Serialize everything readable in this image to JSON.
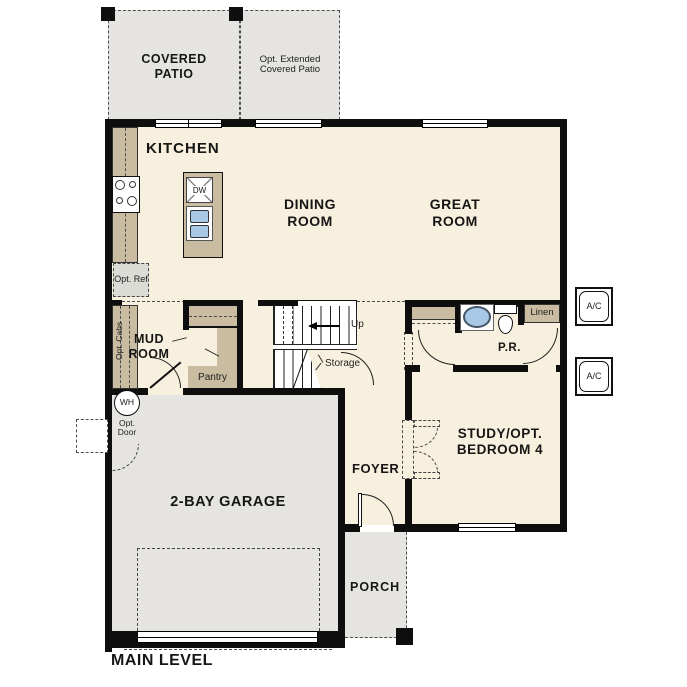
{
  "labels": {
    "level": "MAIN LEVEL",
    "covered_patio": "COVERED PATIO",
    "opt_extended_patio": "Opt. Extended Covered Patio",
    "kitchen": "KITCHEN",
    "dining_room": "DINING ROOM",
    "great_room": "GREAT ROOM",
    "mud_room": "MUD ROOM",
    "pantry": "Pantry",
    "storage": "Storage",
    "up": "Up",
    "opt_ref": "Opt. Ref",
    "opt_cabs": "Opt. Cabs",
    "water_heater": "WH",
    "opt_door": "Opt. Door",
    "powder_room": "P.R.",
    "linen": "Linen",
    "ac": "A/C",
    "dishwasher": "DW",
    "study": "STUDY/OPT. BEDROOM 4",
    "foyer": "FOYER",
    "garage": "2-BAY GARAGE",
    "porch": "PORCH"
  },
  "colors": {
    "interior_cream": "#f8f0de",
    "counter_tan": "#c9bca1",
    "outdoor_gray": "#e5e4e0",
    "sink_blue": "#a9c8e6",
    "wall_black": "#0e0e0e"
  }
}
